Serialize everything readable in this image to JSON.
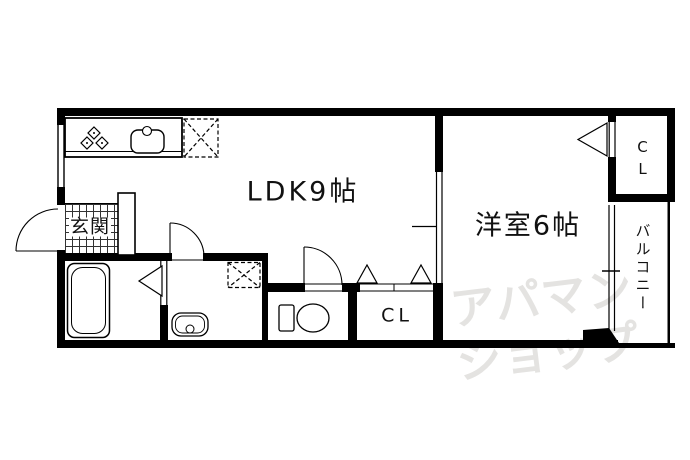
{
  "rooms": {
    "ldk": "LDK9帖",
    "western": "洋室6帖",
    "entrance": "玄関",
    "closet_lower": "CL",
    "closet_upper": "CL",
    "balcony": "バルコニー"
  },
  "fixtures": {
    "gas_stove": "gas-stove-icon",
    "kitchen_sink": "kitchen-sink-icon",
    "refrigerator_space": "refrigerator-space-icon",
    "bathtub": "bathtub-icon",
    "washbasin": "washbasin-icon",
    "washing_machine_space": "washing-machine-space-icon",
    "toilet": "toilet-icon"
  },
  "watermark": {
    "line1": "アパマン",
    "line2": "ショップ"
  },
  "colors": {
    "line": "#000000",
    "background": "#ffffff",
    "watermark": "#e4e3e1"
  }
}
